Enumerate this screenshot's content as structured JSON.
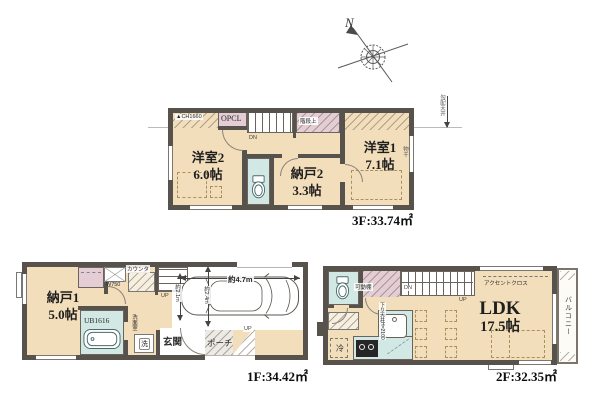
{
  "compass": {
    "north": "N"
  },
  "floor3": {
    "area": "3F:33.74㎡",
    "ch_note": "▲CH1660",
    "opcl": "OPCL",
    "stair_top": "階段上",
    "dn": "DN",
    "slope_note": "勾配天井",
    "laundry_mark": "物干",
    "room_west2": {
      "name": "洋室2",
      "size": "6.0帖"
    },
    "room_storage2": {
      "name": "納戸2",
      "size": "3.3帖"
    },
    "room_west1": {
      "name": "洋室1",
      "size": "7.1帖"
    }
  },
  "floor1": {
    "area": "1F:34.42㎡",
    "room_storage1": {
      "name": "納戸1",
      "size": "5.0帖"
    },
    "counter": "カウンタ",
    "w750": "W750",
    "up_stairs": "UP",
    "bath": "UB1616",
    "washroom": "洗面室",
    "washer": "洗",
    "entrance": "玄関",
    "porch": "ポーチ",
    "up_porch": "UP",
    "car_length": "約4.7m",
    "car_width_left": "約2.1m",
    "car_width_mid": "約2.4m"
  },
  "floor2": {
    "area": "2F:32.35㎡",
    "ldk_name": "LDK",
    "ldk_size": "17.5帖",
    "shelf": "可動棚",
    "accent": "アクセントクロス",
    "dn": "DN",
    "up": "UP",
    "fridge": "冷",
    "balcony": "バルコニー",
    "kitchen_note": "下り天井H=2100"
  },
  "colors": {
    "wall": "#57524c",
    "floor": "#f3debb",
    "water": "#d2e8e4",
    "closet_pink": "#e5cdd6",
    "background": "#ffffff"
  }
}
